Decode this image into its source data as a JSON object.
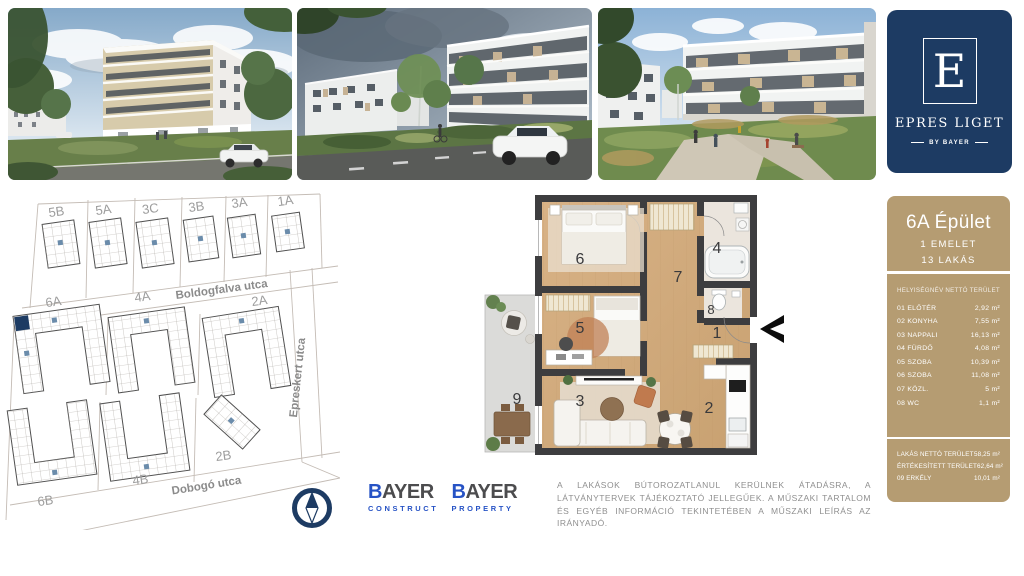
{
  "brand": {
    "letter": "E",
    "name": "EPRES LIGET",
    "byline": "BY BAYER"
  },
  "panel": {
    "building_title": "6A Épület",
    "floor_label": "1 EMELET",
    "units_label": "13 LAKÁS",
    "col_name": "HELYISÉGNÉV",
    "col_area": "NETTÓ TERÜLET",
    "rows": [
      {
        "name": "01 ELŐTÉR",
        "area": "2,92 m²"
      },
      {
        "name": "02 KONYHA",
        "area": "7,55 m²"
      },
      {
        "name": "03 NAPPALI",
        "area": "16,13 m²"
      },
      {
        "name": "04 FÜRDŐ",
        "area": "4,08 m²"
      },
      {
        "name": "05 SZOBA",
        "area": "10,39 m²"
      },
      {
        "name": "06 SZOBA",
        "area": "11,08 m²"
      },
      {
        "name": "07 KÖZL.",
        "area": "5 m²"
      },
      {
        "name": "08 WC",
        "area": "1,1 m²"
      }
    ],
    "summary": [
      {
        "name": "LAKÁS NETTÓ TERÜLET",
        "area": "58,25 m²"
      },
      {
        "name": "ÉRTÉKESÍTETT TERÜLET",
        "area": "62,64 m²"
      },
      {
        "name": "09 ERKÉLY",
        "area": "10,01 m²"
      }
    ],
    "accent_color": "#b59c72"
  },
  "site_plan": {
    "top_buildings": [
      "5B",
      "5A",
      "3C",
      "3B",
      "3A",
      "1A"
    ],
    "mid_buildings": [
      "6A",
      "4A",
      "2A"
    ],
    "bottom_buildings": [
      "6B",
      "4B",
      "2B"
    ],
    "streets": [
      "Boldogfalva utca",
      "Epreskert utca",
      "Dobogó utca"
    ],
    "highlight_color": "#1d3b63"
  },
  "floor_plan": {
    "room_numbers": [
      "1",
      "2",
      "3",
      "4",
      "5",
      "6",
      "7",
      "8",
      "9"
    ]
  },
  "footer": {
    "logos": [
      {
        "brand": "BAYER",
        "division": "CONSTRUCT"
      },
      {
        "brand": "BAYER",
        "division": "PROPERTY"
      }
    ],
    "disclaimer": "A LAKÁSOK BÚTOROZATLANUL KERÜLNEK ÁTADÁSRA, A LÁTVÁNYTERVEK TÁJÉKOZTATÓ JELLEGŰEK. A MŰSZAKI TARTALOM ÉS EGYÉB INFORMÁCIÓ TEKINTETÉBEN A MŰSZAKI LEÍRÁS AZ IRÁNYADÓ."
  },
  "colors": {
    "navy": "#1d3b63",
    "tan": "#b59c72",
    "bayer_blue": "#2753c5"
  }
}
